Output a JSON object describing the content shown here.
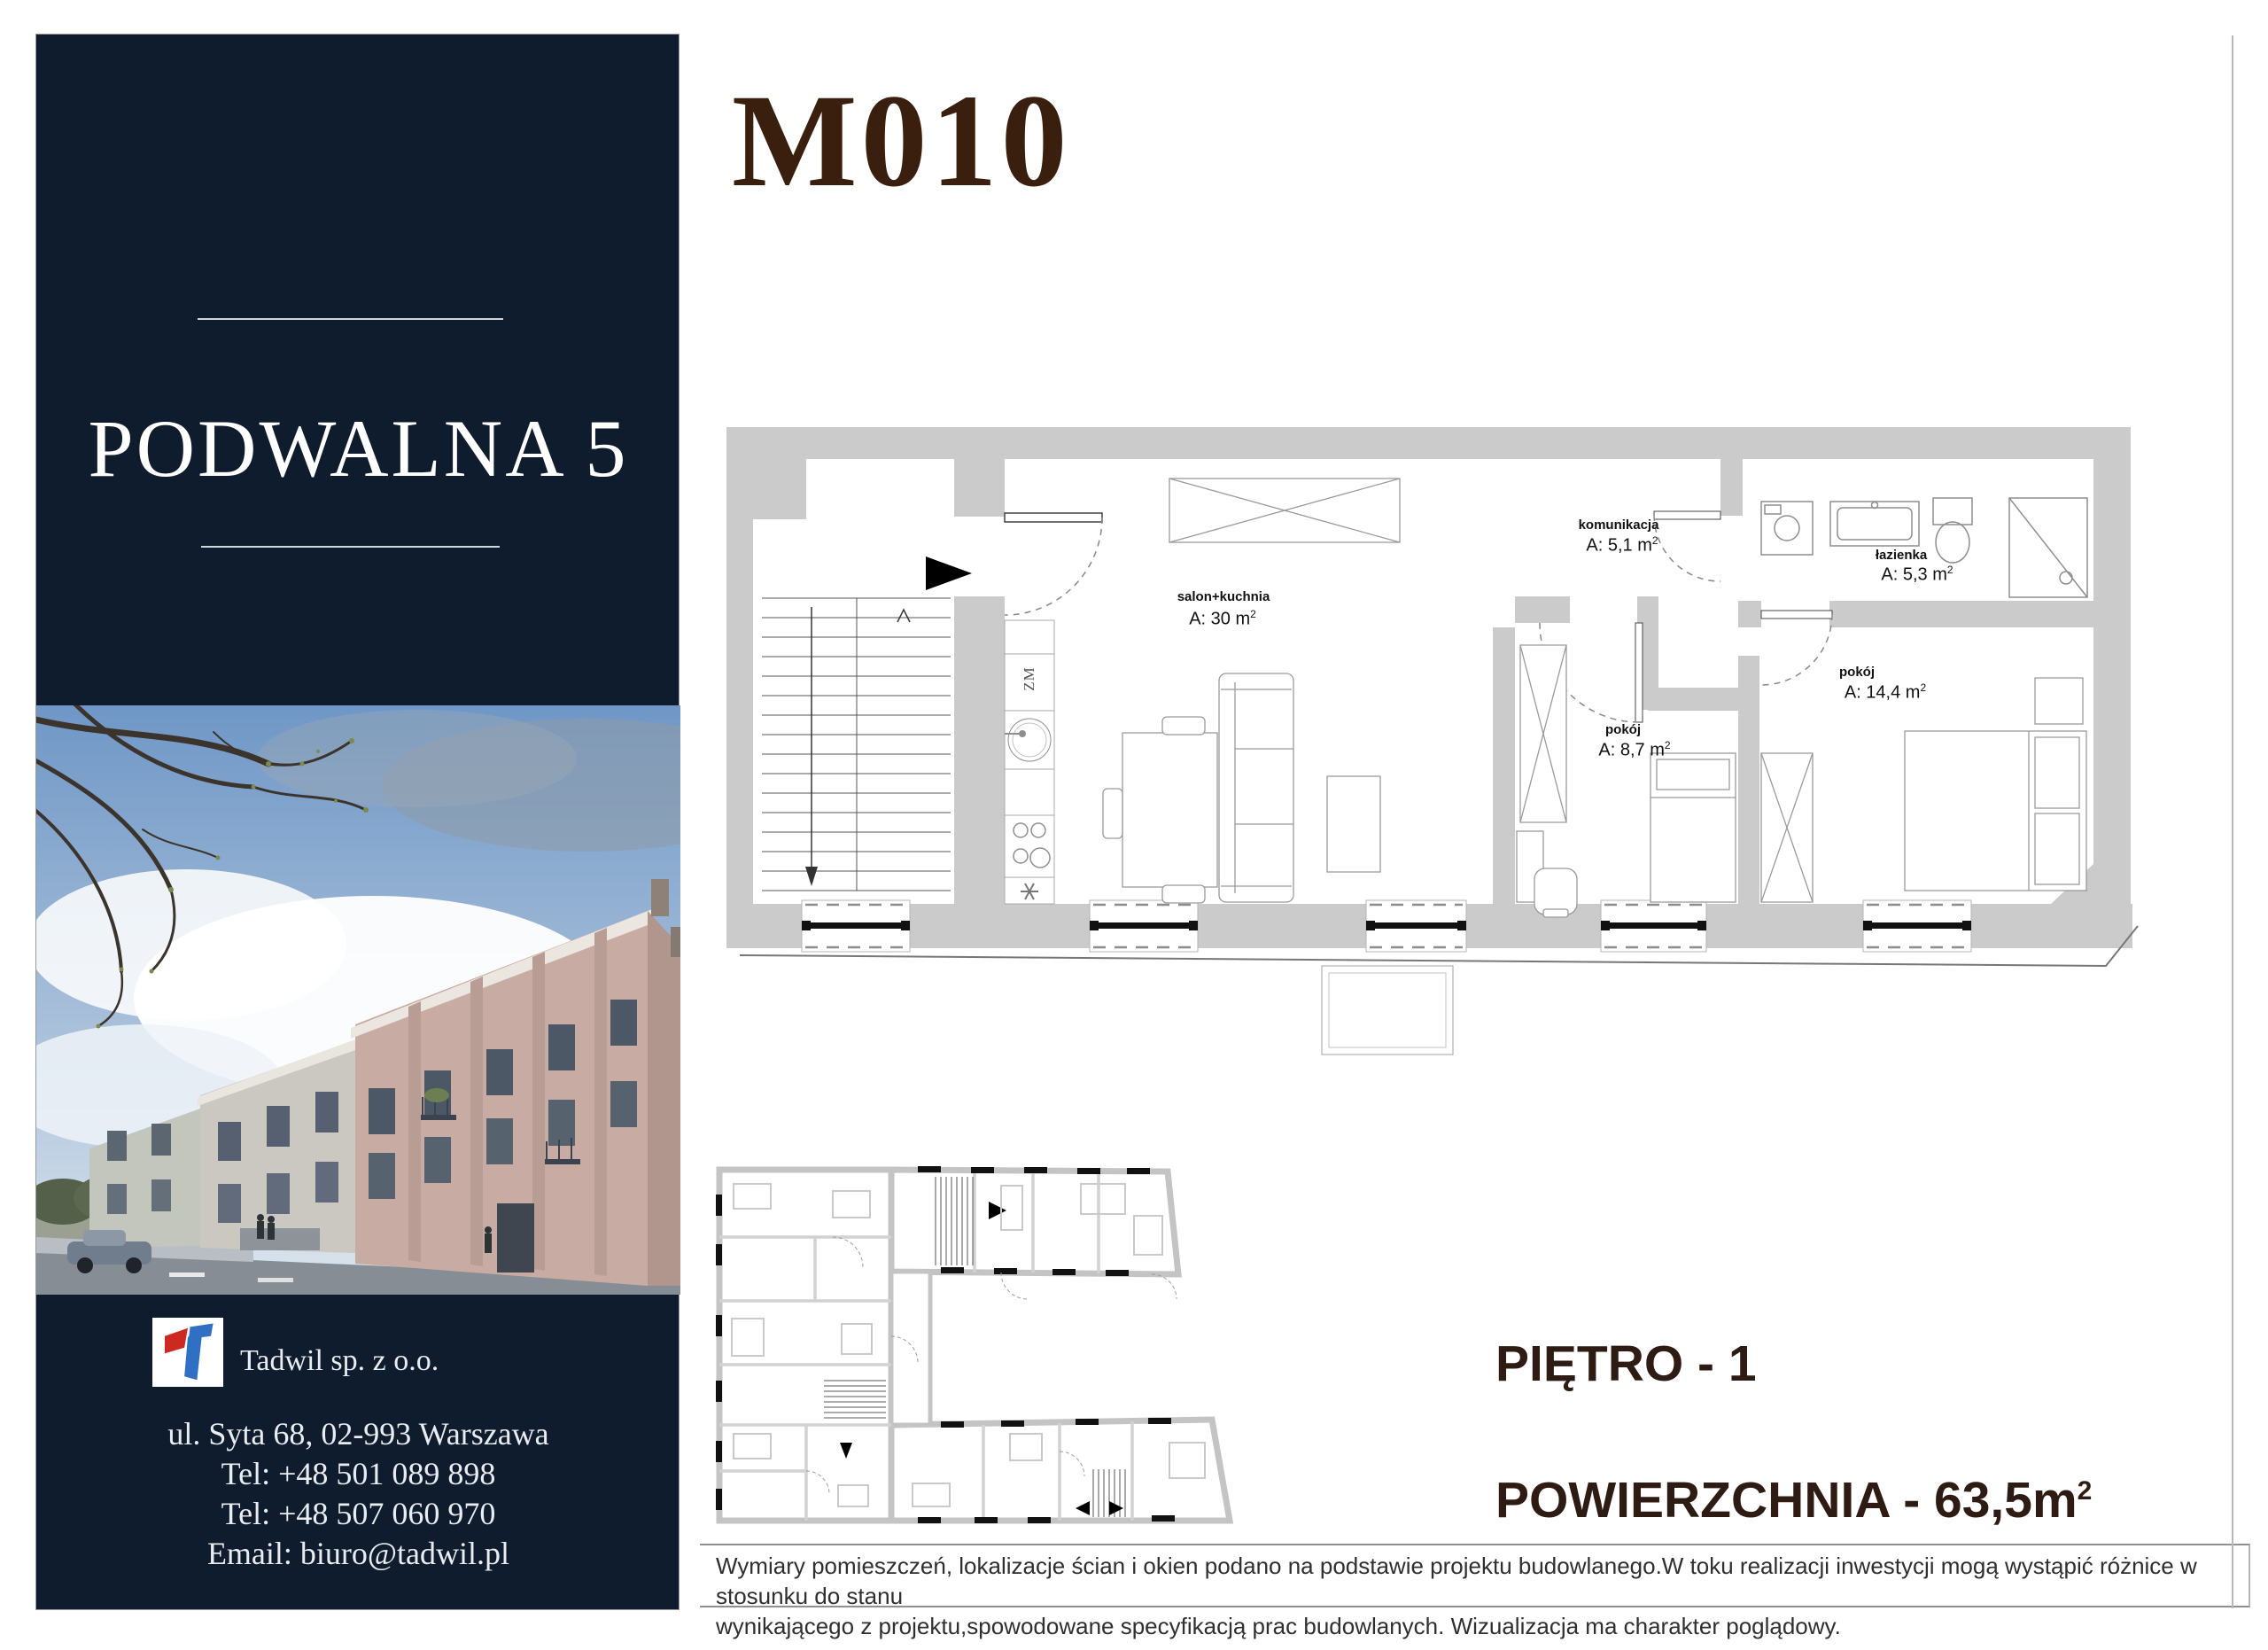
{
  "sidebar": {
    "project_title": "PODWALNA 5",
    "company_name": "Tadwil sp. z o.o.",
    "address": "ul. Syta 68, 02-993 Warszawa",
    "phone1": "Tel: +48 501 089 898",
    "phone2": "Tel: +48 507 060 970",
    "email": "Email: biuro@tadwil.pl"
  },
  "header": {
    "unit_id": "M010"
  },
  "plan": {
    "appliance_label": "ZM",
    "rooms": [
      {
        "name": "salon+kuchnia",
        "area": "A: 30 m",
        "sup": "2"
      },
      {
        "name": "komunikacja",
        "area": "A: 5,1 m",
        "sup": "2"
      },
      {
        "name": "łazienka",
        "area": "A: 5,3 m",
        "sup": "2"
      },
      {
        "name": "pokój",
        "area": "A: 8,7 m",
        "sup": "2"
      },
      {
        "name": "pokój",
        "area": "A: 14,4 m",
        "sup": "2"
      }
    ]
  },
  "details": {
    "floor_label": "PIĘTRO - 1",
    "area_label": "POWIERZCHNIA - 63,5m",
    "area_sup": "2"
  },
  "footer": {
    "line1": "Wymiary pomieszczeń, lokalizacje ścian i okien podano na podstawie projektu budowlanego.W toku realizacji inwestycji mogą wystąpić różnice w stosunku do stanu",
    "line2": "wynikającego z projektu,spowodowane specyfikacją prac budowlanych. Wizualizacja ma charakter poglądowy."
  },
  "colors": {
    "sidebar_navy": "#0e1c2d",
    "title_maroon": "#3a1f0e",
    "details_dark": "#2e1b13",
    "wall_gray": "#cbcbcb"
  }
}
